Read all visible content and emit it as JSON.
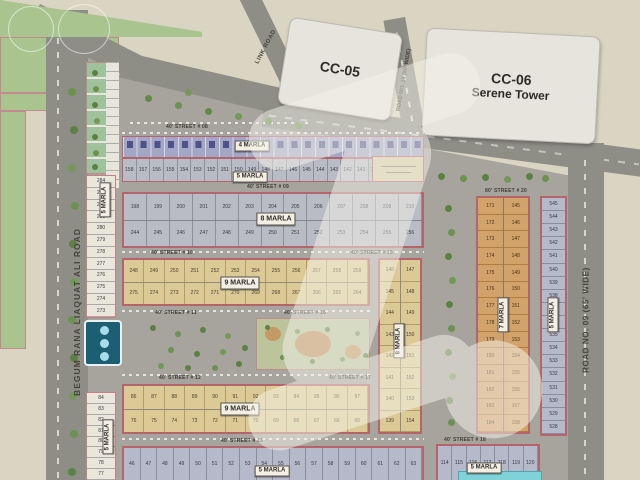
{
  "map": {
    "watermark": "Z",
    "towers": {
      "cc05": "CC-05",
      "cc06": "CC-06",
      "cc06_sub": "Serene Tower"
    },
    "roads": {
      "begum": "BEGUM RANA LIAQUAT ALI ROAD",
      "road09": "ROAD NO. 09 (65' WIDE)",
      "road10": "ROAD NO. 10 (60' WIDE)",
      "link": "LINK ROAD"
    },
    "streets": {
      "s08": "40' STREET # 08",
      "s09": "40' STREET # 09",
      "s10": "40' STREET # 10",
      "s11": "40' STREET # 11",
      "s12": "40' STREET # 12",
      "s13": "40' STREET # 13",
      "s15": "40' STREET # 15",
      "s16": "40' STREET # 16",
      "s17": "40' STREET # 17",
      "s18": "40' STREET # 18",
      "s20": "80' STREET # 20"
    },
    "tags": {
      "t4": "4 MARLA",
      "t5_row": "5 MARLA",
      "t8": "8 MARLA",
      "t9_upper": "9 MARLA",
      "t9_lower": "9 MARLA",
      "t5_bottom": "5 MARLA",
      "t5_bottom_right": "5 MARLA",
      "t5_left_upper": "5 MARLA",
      "t5_left_lower": "5 MARLA",
      "t8_vert": "8 MARLA",
      "t7_vert": "7 MARLA",
      "t5_right_vert": "5 MARLA"
    },
    "plots": {
      "row5m": [
        158,
        157,
        156,
        155,
        154,
        153,
        152,
        151,
        150,
        149,
        148,
        147,
        146,
        145,
        144,
        143,
        142,
        141,
        140,
        139,
        138,
        137
      ],
      "row8m_top": [
        198,
        199,
        200,
        201,
        202,
        203,
        204,
        205,
        206,
        207,
        208,
        209,
        210
      ],
      "row8m_bottom": [
        244,
        245,
        246,
        247,
        248,
        249,
        250,
        251,
        252,
        253,
        254,
        255,
        256
      ],
      "row9a_top": [
        248,
        249,
        250,
        251,
        252,
        253,
        254,
        255,
        256,
        257,
        258,
        259
      ],
      "row9a_bottom": [
        275,
        274,
        273,
        272,
        271,
        270,
        269,
        268,
        267,
        266,
        265,
        264
      ],
      "row9b_top": [
        86,
        87,
        88,
        89,
        90,
        91,
        92,
        93,
        94,
        95,
        96,
        97
      ],
      "row9b_bottom": [
        76,
        75,
        74,
        73,
        72,
        71,
        70,
        69,
        68,
        67,
        66,
        65
      ],
      "row5m_bottom_left": [
        46,
        47,
        48,
        49,
        50,
        51,
        52,
        53,
        54,
        55,
        56,
        57,
        58,
        59,
        60,
        61,
        62,
        63
      ],
      "row5m_bottom_right": [
        114,
        115,
        116,
        117,
        118,
        119,
        120
      ],
      "left_col_upper": [
        284,
        283,
        282,
        281,
        280,
        279,
        278,
        277,
        276,
        275,
        274,
        273
      ],
      "left_col_lower": [
        84,
        83,
        82,
        81,
        80,
        79,
        78,
        77
      ],
      "right_col": [
        545,
        544,
        543,
        542,
        541,
        540,
        539,
        538,
        537,
        536,
        535,
        534,
        533,
        532,
        531,
        530,
        529,
        528
      ],
      "m7_left": [
        171,
        172,
        173,
        174,
        175,
        176,
        177,
        178,
        179,
        180,
        181,
        182,
        183,
        184
      ],
      "m7_right": [
        145,
        146,
        147,
        148,
        149,
        150,
        151,
        152,
        153,
        154,
        155,
        156,
        157,
        158
      ],
      "m8_left": [
        146,
        145,
        144,
        143,
        142,
        141,
        140,
        139
      ],
      "m8_right": [
        147,
        148,
        149,
        150,
        151,
        152,
        153,
        154
      ]
    }
  }
}
